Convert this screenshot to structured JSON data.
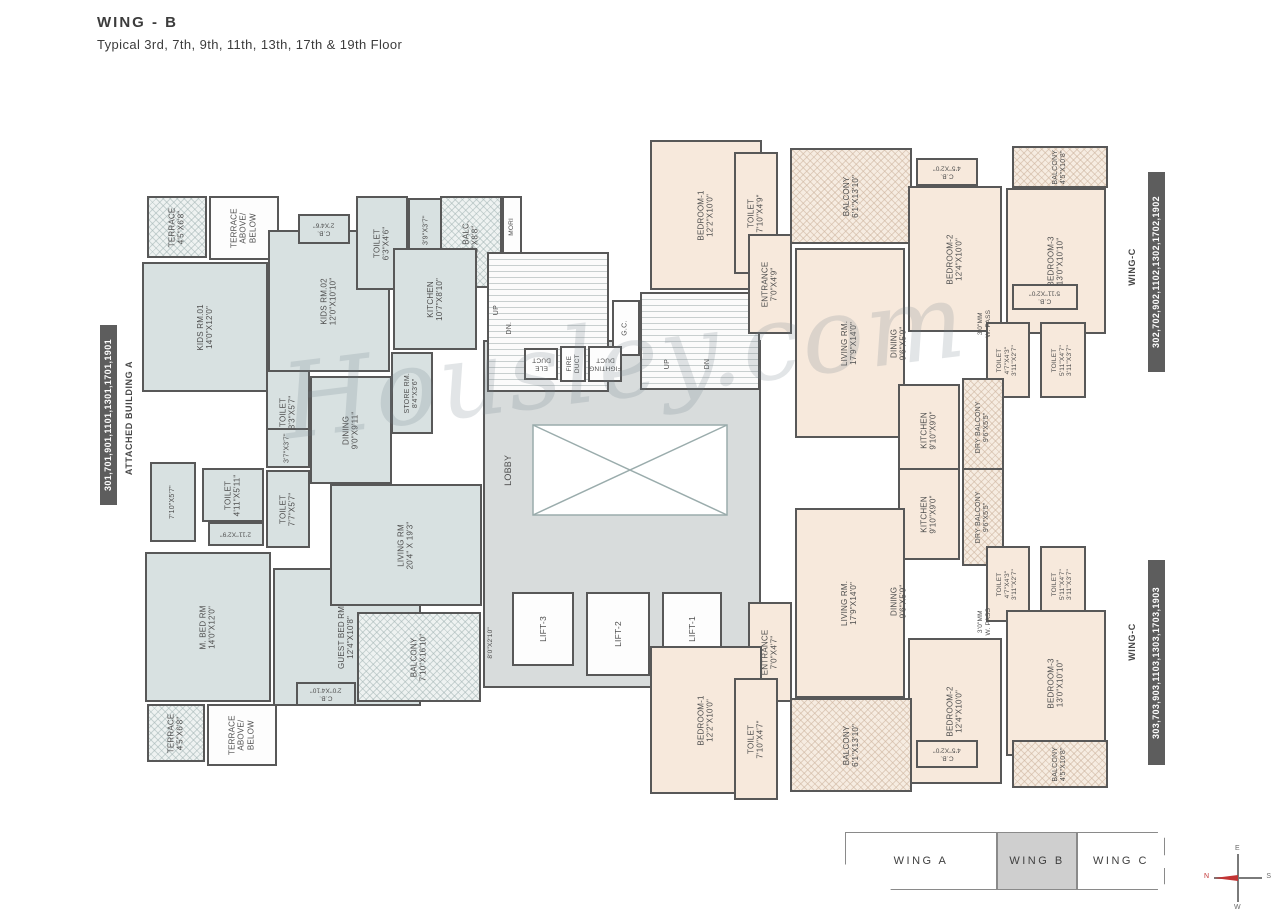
{
  "title": "WING - B",
  "subtitle": "Typical 3rd, 7th, 9th, 11th, 13th, 17th & 19th Floor",
  "watermark": "Housley.com",
  "side_labels": {
    "left_units": "301,701,901,1101,1301,1701,1901",
    "left_building": "ATTACHED BUILDING A",
    "right_top_units": "302,702,902,1102,1302,1702,1902",
    "right_top_wing": "WING-C",
    "right_bottom_units": "303,703,903,1103,1303,1703,1903",
    "right_bottom_wing": "WING-C"
  },
  "key_plan": {
    "wings": [
      "WING A",
      "WING B",
      "WING C"
    ],
    "active": "WING B"
  },
  "compass": {
    "n": "N",
    "e": "E",
    "s": "S",
    "w": "W"
  },
  "colors": {
    "unit_left": "#d8e1e1",
    "unit_right": "#f7e9dc",
    "wall": "#585858",
    "lobby": "#d8dcdc",
    "compass_north": "#c23434"
  },
  "rooms": [
    {
      "name": "terrace-top",
      "lines": [
        "TERRACE",
        "4'5\"X6'8\""
      ],
      "x": 147,
      "y": 196,
      "w": 60,
      "h": 62,
      "rot": 270,
      "fill": "hatch-blue"
    },
    {
      "name": "terrace-above-below-top",
      "lines": [
        "TERRACE",
        "ABOVE/",
        "BELOW"
      ],
      "x": 209,
      "y": 196,
      "w": 70,
      "h": 64,
      "rot": 270,
      "fill": "white"
    },
    {
      "name": "kids-rm-01",
      "lines": [
        "KIDS RM.01",
        "14'0\"X12'0\""
      ],
      "x": 142,
      "y": 262,
      "w": 126,
      "h": 130,
      "rot": 270,
      "fill": "blue"
    },
    {
      "name": "kids-rm-02",
      "lines": [
        "KIDS RM.02",
        "12'0\"X10'10\""
      ],
      "x": 268,
      "y": 230,
      "w": 122,
      "h": 142,
      "rot": 270,
      "fill": "blue"
    },
    {
      "name": "cb-kids",
      "lines": [
        "C.B.",
        "2'X4'6\""
      ],
      "x": 298,
      "y": 214,
      "w": 52,
      "h": 30,
      "rot": 180,
      "fill": "blue",
      "fs": 6.5
    },
    {
      "name": "toilet-kitchen",
      "lines": [
        "TOILET",
        "6'3\"X4'6\""
      ],
      "x": 356,
      "y": 196,
      "w": 52,
      "h": 94,
      "rot": 270,
      "fill": "blue"
    },
    {
      "name": "niche-39",
      "lines": [
        "3'9\"X3'7\""
      ],
      "x": 408,
      "y": 198,
      "w": 38,
      "h": 64,
      "rot": 270,
      "fill": "blue",
      "fs": 7
    },
    {
      "name": "dry-balc",
      "lines": [
        "DRY BALC.",
        "6'2\"X8'8\""
      ],
      "x": 440,
      "y": 196,
      "w": 62,
      "h": 92,
      "rot": 270,
      "fill": "hatch-blue"
    },
    {
      "name": "mori",
      "lines": [
        "MORI"
      ],
      "x": 502,
      "y": 196,
      "w": 20,
      "h": 62,
      "rot": 270,
      "fill": "white",
      "fs": 6.5
    },
    {
      "name": "kitchen-left",
      "lines": [
        "KITCHEN",
        "10'7\"X8'10\""
      ],
      "x": 393,
      "y": 248,
      "w": 84,
      "h": 102,
      "rot": 270,
      "fill": "blue"
    },
    {
      "name": "store-rm",
      "lines": [
        "STORE RM.",
        "8'4\"X3'6\""
      ],
      "x": 391,
      "y": 352,
      "w": 42,
      "h": 82,
      "rot": 270,
      "fill": "blue",
      "fs": 7
    },
    {
      "name": "toilet-dining",
      "lines": [
        "TOILET",
        "8'3\"X5'7\""
      ],
      "x": 266,
      "y": 370,
      "w": 44,
      "h": 84,
      "rot": 270,
      "fill": "blue"
    },
    {
      "name": "dining-left",
      "lines": [
        "DINING",
        "9'0\"X9'11\""
      ],
      "x": 310,
      "y": 376,
      "w": 82,
      "h": 108,
      "rot": 270,
      "fill": "blue"
    },
    {
      "name": "closet-37",
      "lines": [
        "3'7\"X3'7\""
      ],
      "x": 266,
      "y": 428,
      "w": 44,
      "h": 40,
      "rot": 270,
      "fill": "blue",
      "fs": 7
    },
    {
      "name": "toilet-77",
      "lines": [
        "TOILET",
        "7'7\"X5'7\""
      ],
      "x": 266,
      "y": 470,
      "w": 44,
      "h": 78,
      "rot": 270,
      "fill": "blue"
    },
    {
      "name": "passage-710",
      "lines": [
        "7'10\"X5'7\""
      ],
      "x": 150,
      "y": 462,
      "w": 46,
      "h": 80,
      "rot": 270,
      "fill": "blue",
      "fs": 7
    },
    {
      "name": "toilet-411",
      "lines": [
        "TOILET",
        "4'11\"X5'11\""
      ],
      "x": 202,
      "y": 468,
      "w": 62,
      "h": 54,
      "rot": 270,
      "fill": "blue"
    },
    {
      "name": "cb-211",
      "lines": [
        "2'11\"X2'9\""
      ],
      "x": 208,
      "y": 522,
      "w": 56,
      "h": 24,
      "rot": 180,
      "fill": "blue",
      "fs": 6.5
    },
    {
      "name": "m-bed-rm",
      "lines": [
        "M. BED RM",
        "14'0\"X12'0\""
      ],
      "x": 145,
      "y": 552,
      "w": 126,
      "h": 150,
      "rot": 270,
      "fill": "blue"
    },
    {
      "name": "guest-bed-rm",
      "lines": [
        "GUEST BED RM",
        "12'4\"X10'8\""
      ],
      "x": 273,
      "y": 568,
      "w": 148,
      "h": 138,
      "rot": 270,
      "fill": "blue"
    },
    {
      "name": "terrace-bottom",
      "lines": [
        "TERRACE",
        "4'5\"X6'8\""
      ],
      "x": 147,
      "y": 704,
      "w": 58,
      "h": 58,
      "rot": 270,
      "fill": "hatch-blue"
    },
    {
      "name": "terrace-above-below-bottom",
      "lines": [
        "TERRACE",
        "ABOVE/",
        "BELOW"
      ],
      "x": 207,
      "y": 704,
      "w": 70,
      "h": 62,
      "rot": 270,
      "fill": "white"
    },
    {
      "name": "cb-guest",
      "lines": [
        "C.B.",
        "2'0\"X4'10\""
      ],
      "x": 296,
      "y": 682,
      "w": 60,
      "h": 24,
      "rot": 180,
      "fill": "blue",
      "fs": 6.5
    },
    {
      "name": "living-rm-left",
      "lines": [
        "LIVING RM",
        "20'4\" X 19'3\""
      ],
      "x": 330,
      "y": 484,
      "w": 152,
      "h": 122,
      "rot": 270,
      "fill": "blue"
    },
    {
      "name": "balcony-left",
      "lines": [
        "BALCONY",
        "7'10\"X16'10\""
      ],
      "x": 357,
      "y": 612,
      "w": 124,
      "h": 90,
      "rot": 270,
      "fill": "hatch-blue"
    },
    {
      "name": "niche-80",
      "lines": [
        "8'0\"X2'10\""
      ],
      "x": 478,
      "y": 606,
      "w": 26,
      "h": 74,
      "rot": 270,
      "fill": "none",
      "fs": 6.5
    },
    {
      "name": "lobby",
      "lines": [],
      "x": 483,
      "y": 340,
      "w": 278,
      "h": 348,
      "rot": 270,
      "fill": "gray"
    },
    {
      "name": "lobby-label",
      "lines": [
        "LOBBY"
      ],
      "x": 495,
      "y": 430,
      "w": 26,
      "h": 80,
      "rot": 270,
      "fill": "none",
      "fs": 9
    },
    {
      "name": "stair-left",
      "lines": [],
      "x": 487,
      "y": 252,
      "w": 122,
      "h": 140,
      "rot": 270,
      "fill": "stairs"
    },
    {
      "name": "stair-left-up",
      "lines": [
        "UP"
      ],
      "x": 489,
      "y": 296,
      "w": 16,
      "h": 28,
      "rot": 270,
      "fill": "none",
      "fs": 7
    },
    {
      "name": "stair-left-dn",
      "lines": [
        "DN."
      ],
      "x": 502,
      "y": 312,
      "w": 16,
      "h": 32,
      "rot": 270,
      "fill": "none",
      "fs": 7
    },
    {
      "name": "gc-shaft",
      "lines": [
        "G.C."
      ],
      "x": 612,
      "y": 300,
      "w": 28,
      "h": 56,
      "rot": 270,
      "fill": "white",
      "fs": 7
    },
    {
      "name": "ele-duct",
      "lines": [
        "ELE",
        "DUCT"
      ],
      "x": 524,
      "y": 348,
      "w": 34,
      "h": 32,
      "rot": 180,
      "fill": "white",
      "fs": 6.5
    },
    {
      "name": "fire-duct",
      "lines": [
        "FIRE",
        "DUCT"
      ],
      "x": 560,
      "y": 346,
      "w": 26,
      "h": 36,
      "rot": 270,
      "fill": "white",
      "fs": 6.5
    },
    {
      "name": "fighting-duct",
      "lines": [
        "FIGHTING",
        "DUCT"
      ],
      "x": 588,
      "y": 346,
      "w": 34,
      "h": 36,
      "rot": 180,
      "fill": "white",
      "fs": 6.5
    },
    {
      "name": "stair-right",
      "lines": [],
      "x": 640,
      "y": 292,
      "w": 120,
      "h": 98,
      "rot": 270,
      "fill": "stairs"
    },
    {
      "name": "stair-right-up",
      "lines": [
        "UP"
      ],
      "x": 660,
      "y": 350,
      "w": 16,
      "h": 28,
      "rot": 270,
      "fill": "none",
      "fs": 7
    },
    {
      "name": "stair-right-dn",
      "lines": [
        "DN"
      ],
      "x": 700,
      "y": 350,
      "w": 16,
      "h": 28,
      "rot": 270,
      "fill": "none",
      "fs": 7
    },
    {
      "name": "lift-3",
      "lines": [
        "LIFT-3"
      ],
      "x": 512,
      "y": 592,
      "w": 62,
      "h": 74,
      "rot": 270,
      "fill": "white",
      "fs": 8.5
    },
    {
      "name": "lift-2",
      "lines": [
        "LIFT-2"
      ],
      "x": 586,
      "y": 592,
      "w": 64,
      "h": 84,
      "rot": 270,
      "fill": "white",
      "fs": 8.5
    },
    {
      "name": "lift-1",
      "lines": [
        "LIFT-1"
      ],
      "x": 662,
      "y": 592,
      "w": 60,
      "h": 74,
      "rot": 270,
      "fill": "white",
      "fs": 8.5
    },
    {
      "name": "bedroom1-302",
      "lines": [
        "BEDROOM-1",
        "12'2\"X10'0\""
      ],
      "x": 650,
      "y": 140,
      "w": 112,
      "h": 150,
      "rot": 270,
      "fill": "peach"
    },
    {
      "name": "toilet-302-entry",
      "lines": [
        "TOILET",
        "7'10\"X4'9\""
      ],
      "x": 734,
      "y": 152,
      "w": 44,
      "h": 122,
      "rot": 270,
      "fill": "peach"
    },
    {
      "name": "entrance-302",
      "lines": [
        "ENTRANCE",
        "7'0\"X4'9\""
      ],
      "x": 748,
      "y": 234,
      "w": 44,
      "h": 100,
      "rot": 270,
      "fill": "peach"
    },
    {
      "name": "balcony-302",
      "lines": [
        "BALCONY",
        "6'1\"X13'10\""
      ],
      "x": 790,
      "y": 148,
      "w": 122,
      "h": 96,
      "rot": 270,
      "fill": "hatch-peach"
    },
    {
      "name": "living-302",
      "lines": [
        "LIVING RM.",
        "17'9\"X14'0\""
      ],
      "x": 795,
      "y": 248,
      "w": 110,
      "h": 190,
      "rot": 270,
      "fill": "peach"
    },
    {
      "name": "dining-302",
      "lines": [
        "DINING",
        "9'6\"X5'9\""
      ],
      "x": 874,
      "y": 290,
      "w": 50,
      "h": 106,
      "rot": 270,
      "fill": "none"
    },
    {
      "name": "cb-302-a",
      "lines": [
        "C.B.",
        "4'5\"X2'0\""
      ],
      "x": 916,
      "y": 158,
      "w": 62,
      "h": 28,
      "rot": 180,
      "fill": "peach",
      "fs": 6.5
    },
    {
      "name": "bedroom2-302",
      "lines": [
        "BEDROOM-2",
        "12'4\"X10'0\""
      ],
      "x": 908,
      "y": 186,
      "w": 94,
      "h": 146,
      "rot": 270,
      "fill": "peach"
    },
    {
      "name": "balcony-302-side",
      "lines": [
        "BALCONY",
        "4'5\"X10'8\""
      ],
      "x": 1012,
      "y": 146,
      "w": 96,
      "h": 42,
      "rot": 270,
      "fill": "hatch-peach",
      "fs": 7
    },
    {
      "name": "bedroom3-302",
      "lines": [
        "BEDROOM-3",
        "13'0\"X10'10\""
      ],
      "x": 1006,
      "y": 188,
      "w": 100,
      "h": 146,
      "rot": 270,
      "fill": "peach"
    },
    {
      "name": "wpass-302",
      "lines": [
        "3'0\"MM",
        "W. PASS"
      ],
      "x": 970,
      "y": 284,
      "w": 30,
      "h": 80,
      "rot": 270,
      "fill": "none",
      "fs": 6.5
    },
    {
      "name": "cb-302-b",
      "lines": [
        "C.B.",
        "5'11\"X2'0\""
      ],
      "x": 1012,
      "y": 284,
      "w": 66,
      "h": 26,
      "rot": 180,
      "fill": "peach",
      "fs": 6.5
    },
    {
      "name": "toilet-302-b",
      "lines": [
        "TOILET",
        "4'7\"X4'3\"",
        "3'11\"X2'7\""
      ],
      "x": 986,
      "y": 322,
      "w": 44,
      "h": 76,
      "rot": 270,
      "fill": "peach",
      "fs": 6.5
    },
    {
      "name": "toilet-302-c",
      "lines": [
        "TOILET",
        "5'11\"X4'7\"",
        "3'11\"X3'7\""
      ],
      "x": 1040,
      "y": 322,
      "w": 46,
      "h": 76,
      "rot": 270,
      "fill": "peach",
      "fs": 6.5
    },
    {
      "name": "kitchen-302",
      "lines": [
        "KITCHEN",
        "9'10\"X9'0\""
      ],
      "x": 898,
      "y": 384,
      "w": 62,
      "h": 92,
      "rot": 270,
      "fill": "peach"
    },
    {
      "name": "dry-balcony-302",
      "lines": [
        "DRY BALCONY",
        "9'6\"X5'5\""
      ],
      "x": 962,
      "y": 378,
      "w": 42,
      "h": 98,
      "rot": 270,
      "fill": "hatch-peach",
      "fs": 7
    },
    {
      "name": "kitchen-303",
      "lines": [
        "KITCHEN",
        "9'10\"X9'0\""
      ],
      "x": 898,
      "y": 468,
      "w": 62,
      "h": 92,
      "rot": 270,
      "fill": "peach"
    },
    {
      "name": "dry-balcony-303",
      "lines": [
        "DRY BALCONY",
        "9'6\"X5'5\""
      ],
      "x": 962,
      "y": 468,
      "w": 42,
      "h": 98,
      "rot": 270,
      "fill": "hatch-peach",
      "fs": 7
    },
    {
      "name": "living-303",
      "lines": [
        "LIVING RM.",
        "17'9\"X14'0\""
      ],
      "x": 795,
      "y": 508,
      "w": 110,
      "h": 190,
      "rot": 270,
      "fill": "peach"
    },
    {
      "name": "dining-303",
      "lines": [
        "DINING",
        "9'6\"X5'9\""
      ],
      "x": 874,
      "y": 548,
      "w": 50,
      "h": 106,
      "rot": 270,
      "fill": "none"
    },
    {
      "name": "toilet-303-b",
      "lines": [
        "TOILET",
        "4'7\"X4'3\"",
        "3'11\"X2'7\""
      ],
      "x": 986,
      "y": 546,
      "w": 44,
      "h": 76,
      "rot": 270,
      "fill": "peach",
      "fs": 6.5
    },
    {
      "name": "toilet-303-c",
      "lines": [
        "TOILET",
        "5'11\"X4'7\"",
        "3'11\"X3'7\""
      ],
      "x": 1040,
      "y": 546,
      "w": 46,
      "h": 76,
      "rot": 270,
      "fill": "peach",
      "fs": 6.5
    },
    {
      "name": "wpass-303",
      "lines": [
        "3'0\"MM",
        "W. PASS"
      ],
      "x": 970,
      "y": 582,
      "w": 30,
      "h": 80,
      "rot": 270,
      "fill": "none",
      "fs": 6.5
    },
    {
      "name": "cb-303-b",
      "lines": [
        "C.B.",
        "5'11\"X2'0\""
      ],
      "x": 1012,
      "y": 610,
      "w": 66,
      "h": 26,
      "rot": 180,
      "fill": "peach",
      "fs": 6.5
    },
    {
      "name": "bedroom2-303",
      "lines": [
        "BEDROOM-2",
        "12'4\"X10'0\""
      ],
      "x": 908,
      "y": 638,
      "w": 94,
      "h": 146,
      "rot": 270,
      "fill": "peach"
    },
    {
      "name": "bedroom3-303",
      "lines": [
        "BEDROOM-3",
        "13'0\"X10'10\""
      ],
      "x": 1006,
      "y": 610,
      "w": 100,
      "h": 146,
      "rot": 270,
      "fill": "peach"
    },
    {
      "name": "cb-303-a",
      "lines": [
        "C.B.",
        "4'5\"X2'0\""
      ],
      "x": 916,
      "y": 740,
      "w": 62,
      "h": 28,
      "rot": 180,
      "fill": "peach",
      "fs": 6.5
    },
    {
      "name": "balcony-303-side",
      "lines": [
        "BALCONY",
        "4'5\"X10'8\""
      ],
      "x": 1012,
      "y": 740,
      "w": 96,
      "h": 48,
      "rot": 270,
      "fill": "hatch-peach",
      "fs": 7
    },
    {
      "name": "entrance-303",
      "lines": [
        "ENTRANCE",
        "7'0\"X4'7\""
      ],
      "x": 748,
      "y": 602,
      "w": 44,
      "h": 100,
      "rot": 270,
      "fill": "peach"
    },
    {
      "name": "bedroom1-303",
      "lines": [
        "BEDROOM-1",
        "12'2\"X10'0\""
      ],
      "x": 650,
      "y": 646,
      "w": 112,
      "h": 148,
      "rot": 270,
      "fill": "peach"
    },
    {
      "name": "toilet-303-entry",
      "lines": [
        "TOILET",
        "7'10\"X4'7\""
      ],
      "x": 734,
      "y": 678,
      "w": 44,
      "h": 122,
      "rot": 270,
      "fill": "peach"
    },
    {
      "name": "balcony-303",
      "lines": [
        "BALCONY",
        "6'1\"X13'10\""
      ],
      "x": 790,
      "y": 698,
      "w": 122,
      "h": 94,
      "rot": 270,
      "fill": "hatch-peach"
    }
  ]
}
